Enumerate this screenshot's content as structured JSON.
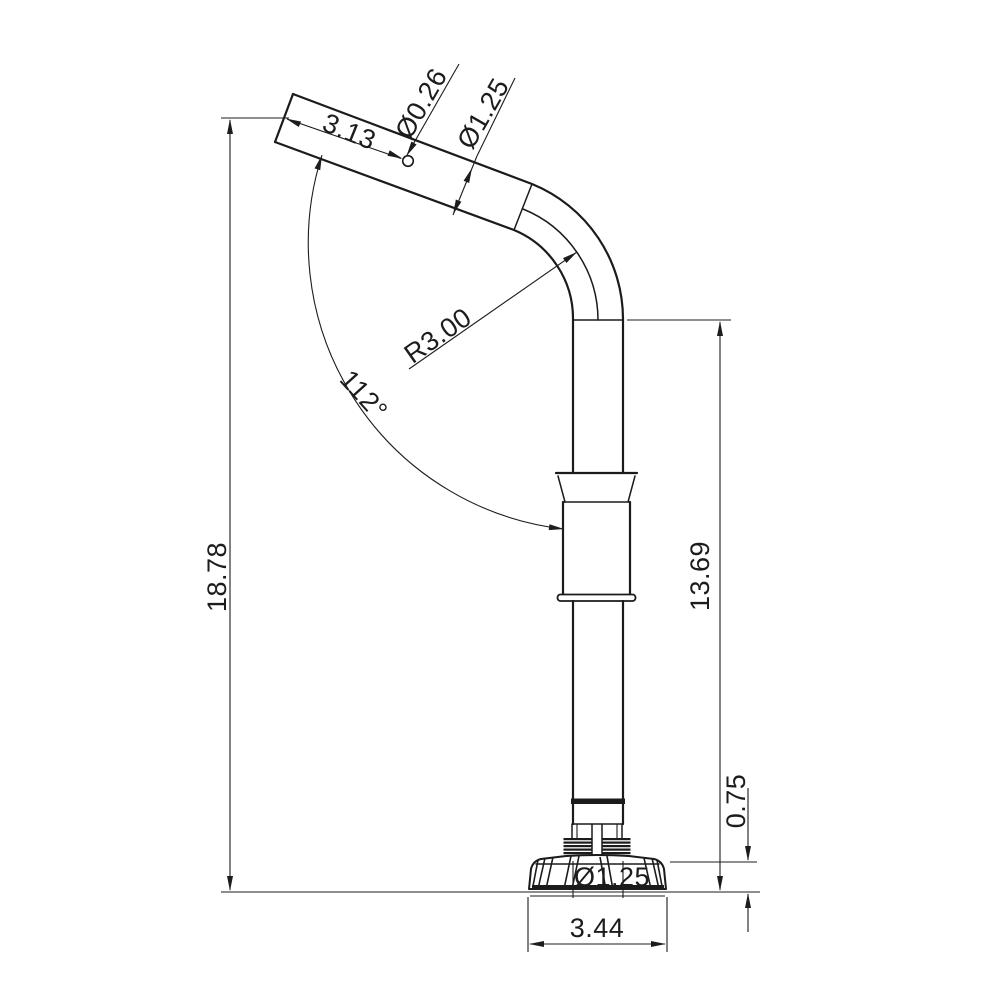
{
  "drawing": {
    "background_color": "#ffffff",
    "line_color": "#1b1b1b",
    "view": "side-view bent pole with knob base",
    "dimensions": {
      "upper_arm_length": "3.13",
      "hole_diameter": "Ø0.26",
      "tube_diameter": "Ø1.25",
      "bend_radius": "R3.00",
      "bend_angle": "112°",
      "overall_height": "18.78",
      "lower_height": "13.69",
      "base_height": "0.75",
      "base_width": "3.44",
      "base_tube_diameter": "Ø1.25"
    }
  }
}
